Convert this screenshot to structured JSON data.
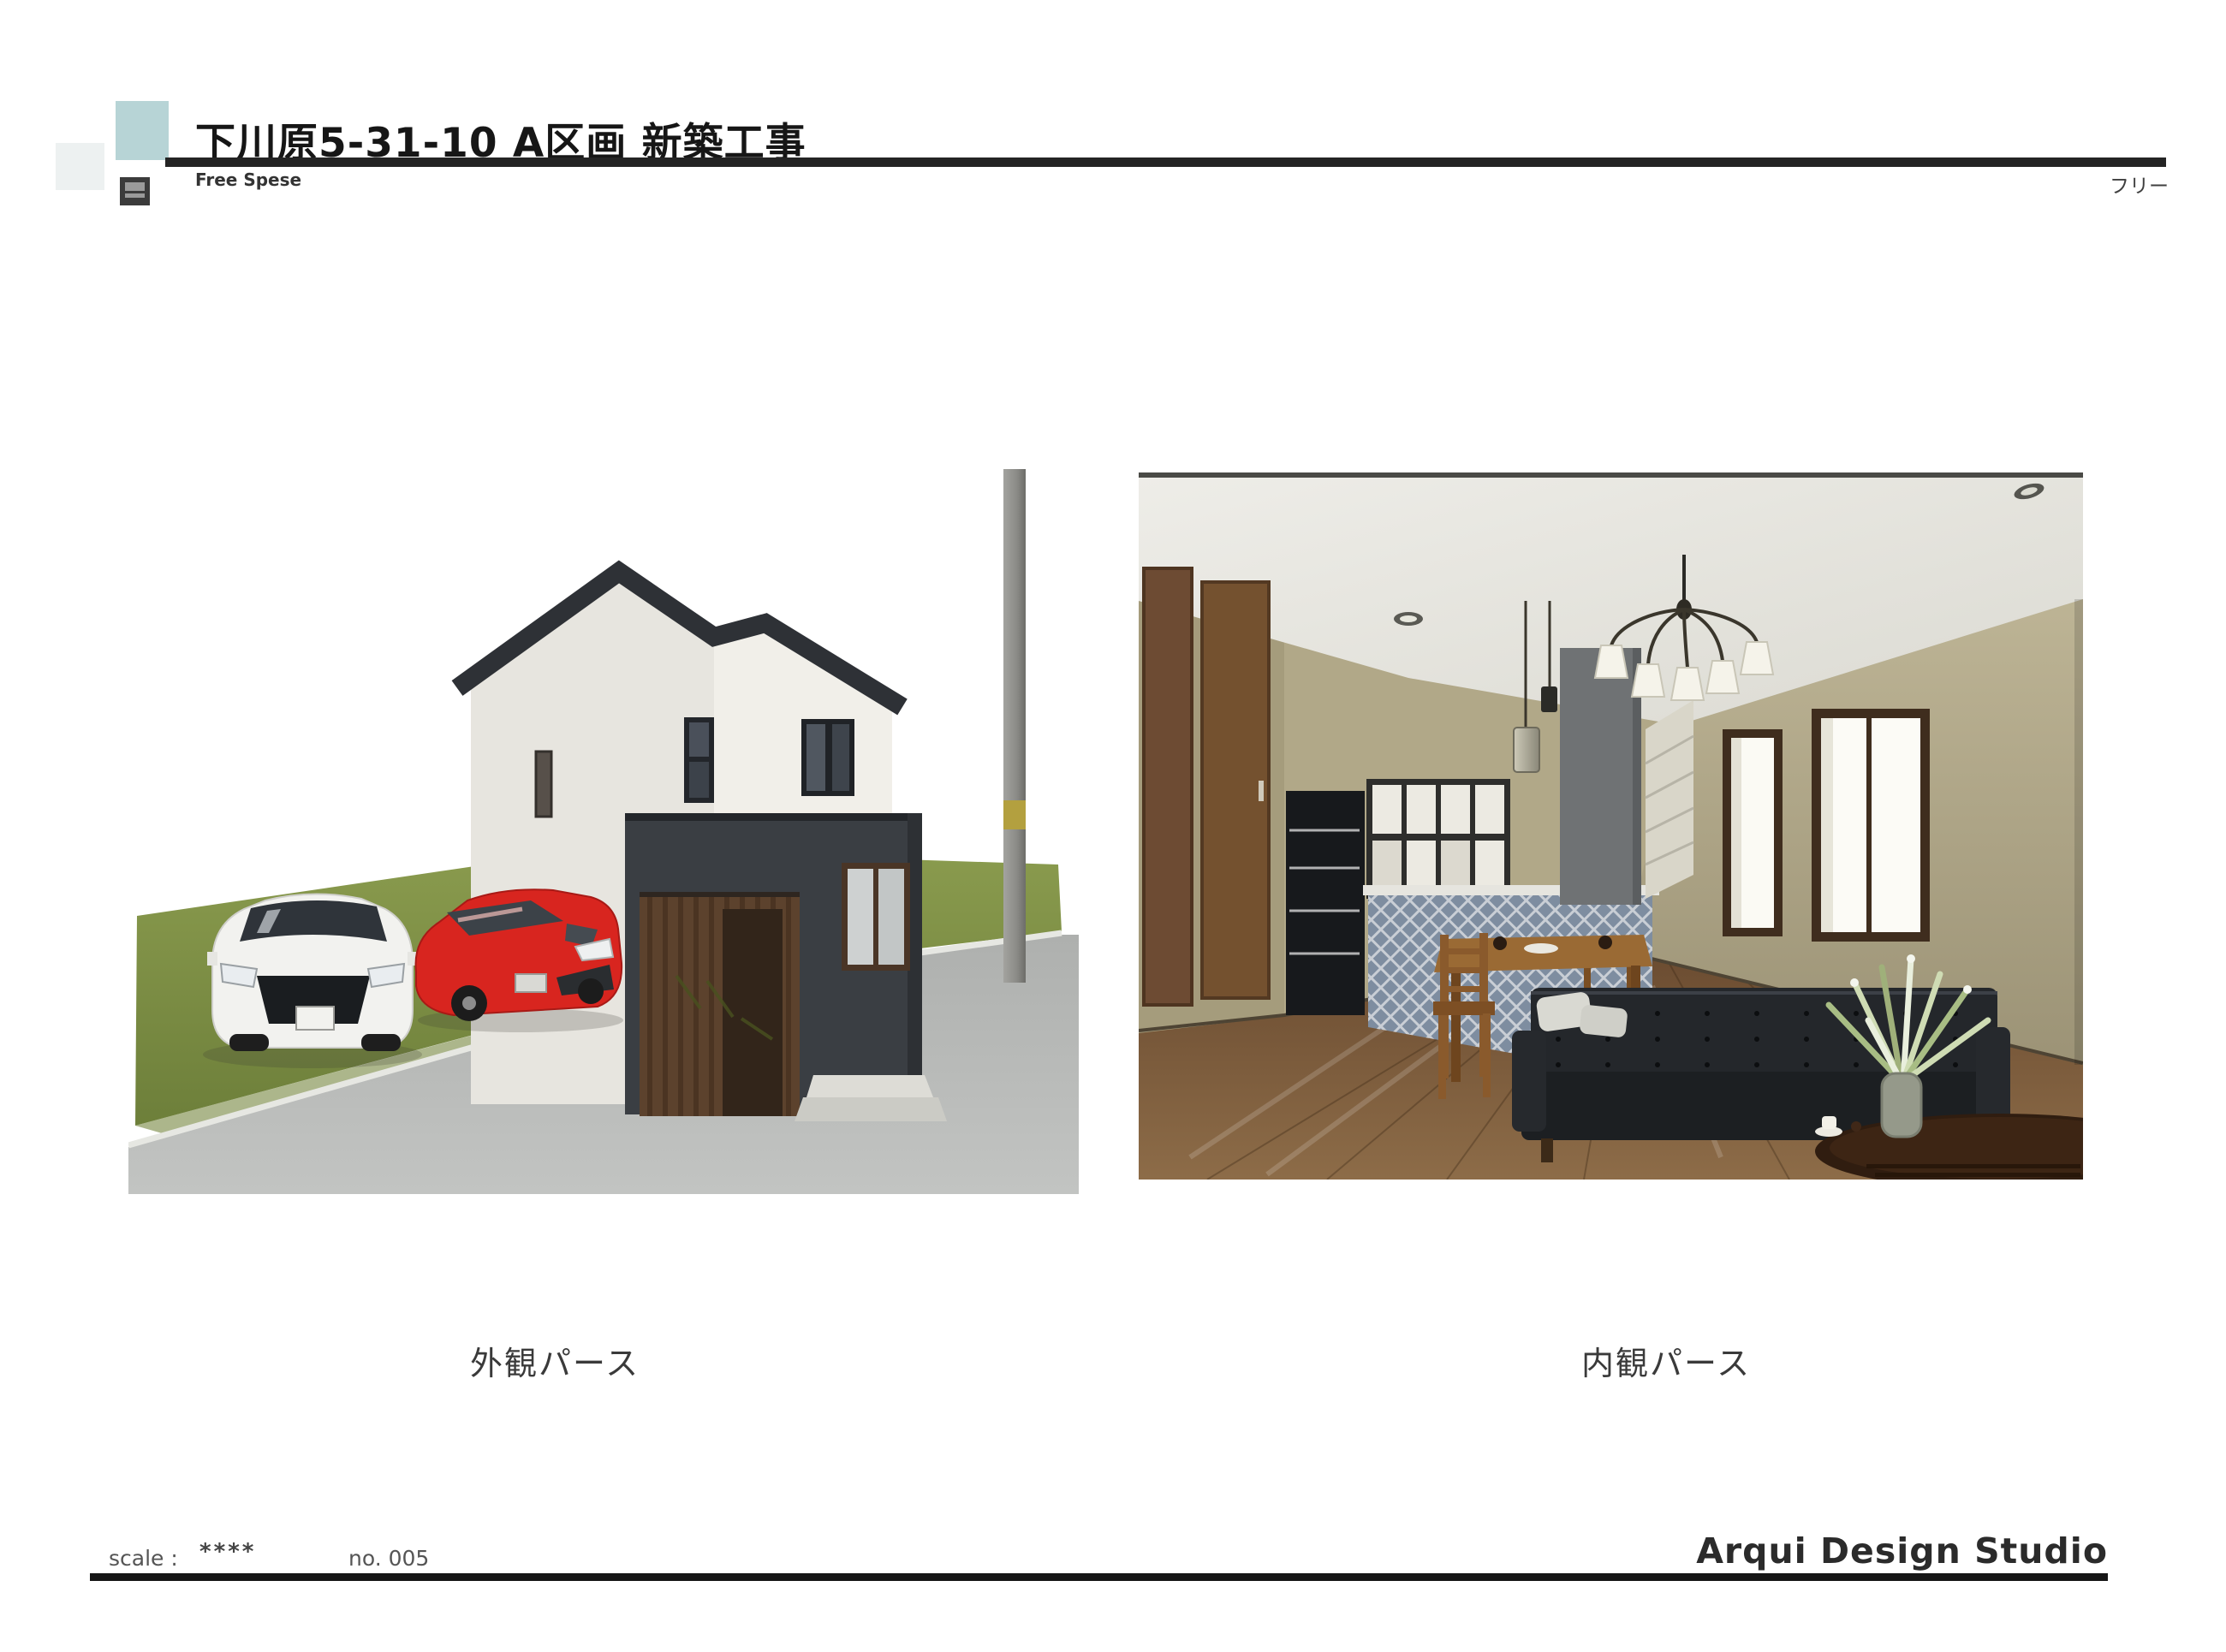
{
  "header": {
    "title": "下川原5-31-10 A区画 新築工事",
    "subtitle": "Free Spese",
    "right_label": "フリー",
    "accent_square_color": "#b7d4d6"
  },
  "captions": {
    "exterior": "外観パース",
    "interior": "内観パース"
  },
  "footer": {
    "scale_label": "scale :",
    "scale_value": "****",
    "sheet_no": "no. 005",
    "studio": "Arqui Design Studio"
  },
  "palette": {
    "rule_dark": "#1c1c1c",
    "house_wall": "#efede8",
    "house_dark_volume": "#3a3e43",
    "roof": "#2e3136",
    "garage_wood": "#5c422d",
    "lawn_green": "#7d8f45",
    "road_gray": "#b5b7b5",
    "suv_white": "#f2f2ef",
    "car_red": "#d8251f",
    "interior_wall": "#b1a888",
    "floor_wood": "#7d5c3c",
    "sofa_black": "#1f2226",
    "kitchen_tile": "#7e8da0"
  },
  "scenes": {
    "exterior": {
      "objects": [
        "two-story house",
        "garage with wood door",
        "white suv",
        "red hatchback",
        "utility pole",
        "lawn",
        "road",
        "entry steps"
      ]
    },
    "interior": {
      "objects": [
        "chandelier",
        "downlights",
        "pendant lamp",
        "left doors",
        "refrigerator",
        "glass cabinet",
        "tiled kitchen counter",
        "dining table and chairs",
        "black leather sofa",
        "coffee table",
        "potted plant",
        "two windows",
        "wood floor"
      ]
    }
  }
}
